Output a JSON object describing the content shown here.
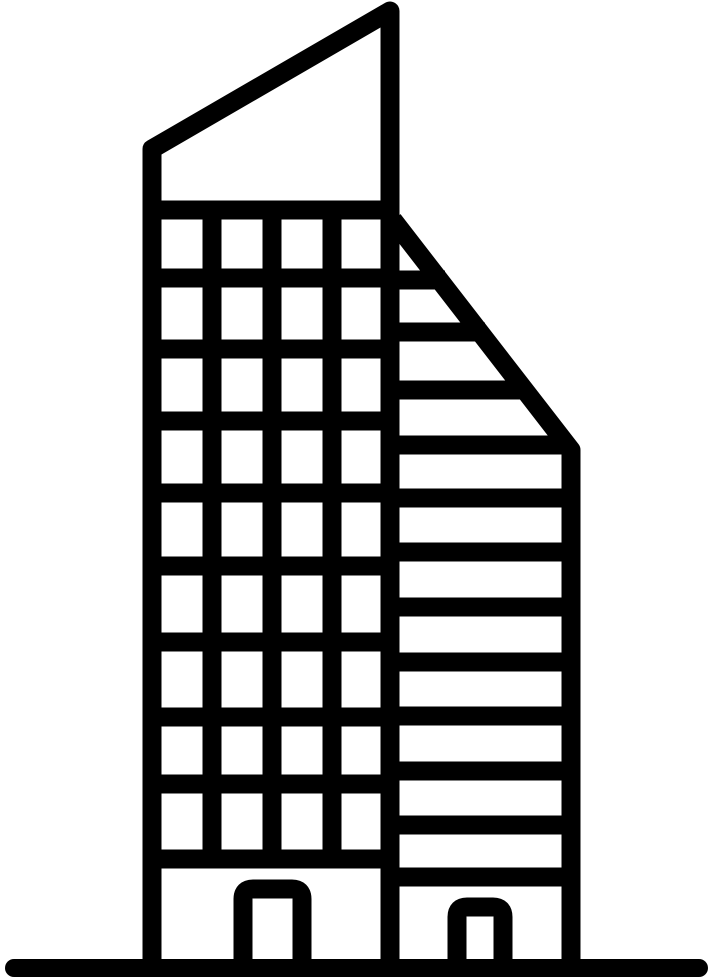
{
  "page": {
    "background_color": "#ffffff"
  },
  "icon": {
    "name": "skyscraper-building-line-icon",
    "style": "black-outline",
    "stroke_color": "#000000",
    "background_color": "#ffffff",
    "stroke_width": 19,
    "canvas_width": 713,
    "canvas_height": 980
  },
  "building": {
    "left_tower": {
      "outline_points": [
        [
          152,
          961
        ],
        [
          152,
          149
        ],
        [
          390,
          11
        ],
        [
          390,
          961
        ]
      ],
      "floor_lines": {
        "x1": 152,
        "x2": 390,
        "ys": [
          210,
          278,
          349,
          421,
          493,
          566,
          642,
          717,
          784,
          859
        ]
      },
      "window_mullions": {
        "y1": 210,
        "y2": 859,
        "xs": [
          212,
          272,
          332
        ]
      },
      "door": {
        "x1": 243,
        "x2": 302,
        "top": 889,
        "bottom": 966,
        "corner_radius": 10
      }
    },
    "right_tower": {
      "outline_points": [
        [
          393,
          220
        ],
        [
          571,
          450
        ],
        [
          571,
          961
        ]
      ],
      "stripe_lines": {
        "x1": 390,
        "stripes": [
          [
            280,
            445
          ],
          [
            332,
            485
          ],
          [
            390,
            529
          ],
          [
            445,
            569
          ],
          [
            498,
            571
          ],
          [
            552,
            571
          ],
          [
            607,
            571
          ],
          [
            662,
            571
          ],
          [
            716,
            571
          ],
          [
            771,
            571
          ],
          [
            825,
            571
          ],
          [
            877,
            571
          ]
        ]
      },
      "door": {
        "x1": 457,
        "x2": 503,
        "top": 907,
        "bottom": 966,
        "corner_radius": 10
      }
    },
    "ground_line": {
      "x1": 14,
      "x2": 699,
      "y": 968,
      "stroke_width": 18
    }
  }
}
